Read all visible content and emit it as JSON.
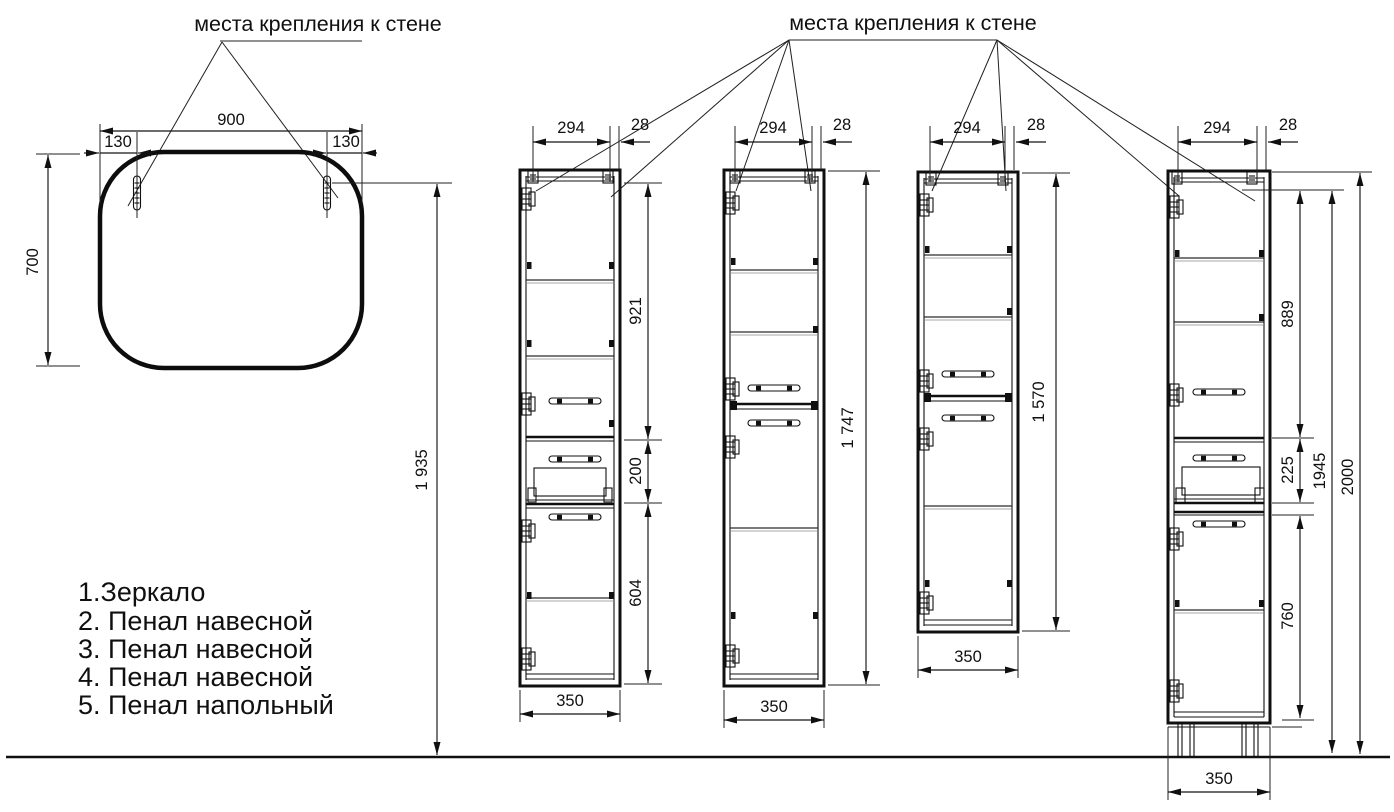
{
  "drawing": {
    "wall_mount_label_left": "места крепления к стене",
    "wall_mount_label_right": "места крепления к стене",
    "mirror": {
      "width": "900",
      "hook_offset_left": "130",
      "hook_offset_right": "130",
      "height": "700",
      "mount_height": "1 935"
    },
    "cabinet_2": {
      "mount_span": "294",
      "mount_inset": "28",
      "upper_section": "921",
      "drawer_section": "200",
      "lower_section": "604",
      "width": "350"
    },
    "cabinet_3": {
      "mount_span": "294",
      "mount_inset": "28",
      "height": "1 747",
      "width": "350"
    },
    "cabinet_4": {
      "mount_span": "294",
      "mount_inset": "28",
      "height": "1 570",
      "width": "350"
    },
    "cabinet_5": {
      "mount_span": "294",
      "mount_inset": "28",
      "upper_section": "889",
      "drawer_section": "225",
      "lower_section": "760",
      "body_height": "1945",
      "total_height": "2000",
      "width": "350"
    },
    "legend": {
      "items": [
        "1.Зеркало",
        "2. Пенал навесной",
        "3. Пенал навесной",
        "4. Пенал навесной",
        "5. Пенал напольный"
      ]
    }
  },
  "colors": {
    "line": "#101010",
    "background": "#ffffff"
  }
}
